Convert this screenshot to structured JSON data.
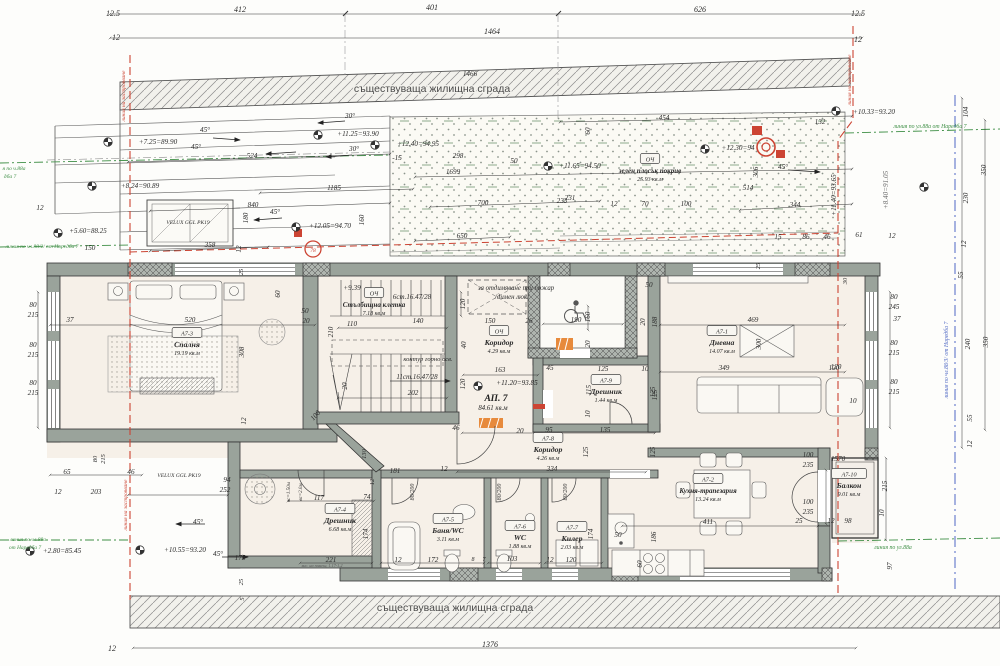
{
  "colors": {
    "wall": "#9aa39b",
    "hatch": "#8c8c8c",
    "red": "#cc4433",
    "green": "#3f8f46",
    "blue": "#4f68c4",
    "paper": "#f6f0e8"
  },
  "bands": {
    "top": "съществуваща жилищна сграда",
    "bottom": "съществуваща жилищна сграда"
  },
  "apartment": {
    "label": "АП. 7",
    "area": "84.61 кв.м",
    "level": "+11.20=93.85"
  },
  "rooms": [
    {
      "tag": "А7-3",
      "name": "Спалня",
      "area": "19.19 кв.м",
      "x": 187,
      "y": 338
    },
    {
      "tag": "ОЧ",
      "name": "Стълбищна клетка",
      "area": "7.18 кв.м",
      "x": 374,
      "y": 298
    },
    {
      "tag": "ОЧ",
      "name": "Коридор",
      "area": "4.29 кв.м",
      "x": 499,
      "y": 336
    },
    {
      "tag": "А7-9",
      "name": "Дрешник",
      "area": "1.44 кв.м",
      "x": 606,
      "y": 385
    },
    {
      "tag": "А7-1",
      "name": "Дневна",
      "area": "14.07 кв.м",
      "x": 722,
      "y": 336
    },
    {
      "tag": "А7-8",
      "name": "Коридор",
      "area": "4.26 кв.м",
      "x": 548,
      "y": 443
    },
    {
      "tag": "А7-2",
      "name": "Кухня-трапезария",
      "area": "13.24 кв.м",
      "x": 708,
      "y": 484
    },
    {
      "tag": "А7-10",
      "name": "Балкон",
      "area": "9.01 кв.м",
      "x": 849,
      "y": 479
    },
    {
      "tag": "А7-4",
      "name": "Дрешник",
      "area": "6.68 кв.м",
      "x": 340,
      "y": 514
    },
    {
      "tag": "А7-5",
      "name": "Баня/WC",
      "area": "3.11 кв.м",
      "x": 448,
      "y": 524
    },
    {
      "tag": "А7-6",
      "name": "WC",
      "area": "1.88 кв.м",
      "x": 520,
      "y": 531
    },
    {
      "tag": "А7-7",
      "name": "Килер",
      "area": "2.03 кв.м",
      "x": 572,
      "y": 532
    },
    {
      "tag": "ОЧ",
      "name": "зелен плосък покрив",
      "area": "25.93 кв.м",
      "x": 650,
      "y": 164
    }
  ],
  "level_markers": [
    {
      "x": 108,
      "y": 142
    },
    {
      "x": 92,
      "y": 186
    },
    {
      "x": 58,
      "y": 233
    },
    {
      "x": 318,
      "y": 135
    },
    {
      "x": 375,
      "y": 145
    },
    {
      "x": 296,
      "y": 227
    },
    {
      "x": 548,
      "y": 166
    },
    {
      "x": 836,
      "y": 111
    },
    {
      "x": 478,
      "y": 386
    },
    {
      "x": 140,
      "y": 550
    },
    {
      "x": 30,
      "y": 551
    },
    {
      "x": 705,
      "y": 149
    },
    {
      "x": 924,
      "y": 187
    }
  ],
  "labels": [
    {
      "t": "12.5",
      "x": 113,
      "y": 16,
      "s": 8
    },
    {
      "t": "412",
      "x": 240,
      "y": 12,
      "s": 8
    },
    {
      "t": "401",
      "x": 432,
      "y": 10,
      "s": 8
    },
    {
      "t": "626",
      "x": 700,
      "y": 12,
      "s": 8
    },
    {
      "t": "12.5",
      "x": 858,
      "y": 16,
      "s": 8
    },
    {
      "t": "12",
      "x": 116,
      "y": 40,
      "s": 8
    },
    {
      "t": "1464",
      "x": 492,
      "y": 34,
      "s": 8
    },
    {
      "t": "12",
      "x": 858,
      "y": 42,
      "s": 8
    },
    {
      "t": "1466",
      "x": 470,
      "y": 76
    },
    {
      "t": "+7.25=89.90",
      "x": 158,
      "y": 144
    },
    {
      "t": "45°",
      "x": 205,
      "y": 132
    },
    {
      "t": "45°",
      "x": 196,
      "y": 149
    },
    {
      "t": "30°",
      "x": 350,
      "y": 118
    },
    {
      "t": "+11.25=93.90",
      "x": 358,
      "y": 136
    },
    {
      "t": "30°",
      "x": 354,
      "y": 151
    },
    {
      "t": "524",
      "x": 252,
      "y": 158
    },
    {
      "t": "+12.40=94.95",
      "x": 418,
      "y": 146
    },
    {
      "t": "-15",
      "x": 397,
      "y": 160
    },
    {
      "t": "298",
      "x": 458,
      "y": 158
    },
    {
      "t": "50",
      "x": 514,
      "y": 163
    },
    {
      "t": "1699",
      "x": 453,
      "y": 174
    },
    {
      "t": "+8.24=90.89",
      "x": 140,
      "y": 188
    },
    {
      "t": "1185",
      "x": 334,
      "y": 190
    },
    {
      "t": "840",
      "x": 253,
      "y": 207
    },
    {
      "t": "180",
      "x": 248,
      "y": 218,
      "r": -90
    },
    {
      "t": "45°",
      "x": 275,
      "y": 214
    },
    {
      "t": "700",
      "x": 483,
      "y": 205
    },
    {
      "t": "233",
      "x": 562,
      "y": 203
    },
    {
      "t": "+12.05=94.70",
      "x": 330,
      "y": 228
    },
    {
      "t": "650",
      "x": 462,
      "y": 238
    },
    {
      "t": "358",
      "x": 210,
      "y": 247
    },
    {
      "t": "12",
      "x": 241,
      "y": 249,
      "r": -90
    },
    {
      "t": "160",
      "x": 364,
      "y": 220,
      "r": -90
    },
    {
      "t": "+5.60=88.25",
      "x": 88,
      "y": 233,
      "s": 7
    },
    {
      "t": "150",
      "x": 90,
      "y": 250
    },
    {
      "t": "12",
      "x": 40,
      "y": 210
    },
    {
      "t": "VELUX GGL PK19",
      "x": 188,
      "y": 224,
      "s": 5.5,
      "n": "skylight-label"
    },
    {
      "t": "454",
      "x": 664,
      "y": 120
    },
    {
      "t": "132",
      "x": 820,
      "y": 124
    },
    {
      "t": "+10.33=93.20",
      "x": 874,
      "y": 114
    },
    {
      "t": "линия по ул.88а от Наредба 7",
      "x": 930,
      "y": 128,
      "s": 5.8,
      "c": "#3f8f46",
      "n": "regulation-line-label"
    },
    {
      "t": "+11.65=94.50",
      "x": 580,
      "y": 168
    },
    {
      "t": "+12.30=94",
      "x": 738,
      "y": 150
    },
    {
      "t": "45°",
      "x": 783,
      "y": 169
    },
    {
      "t": "+8.40=91.05",
      "x": 888,
      "y": 190,
      "r": -90,
      "c": "#6a6a6a"
    },
    {
      "t": "+11.40=93.65",
      "x": 836,
      "y": 195,
      "r": -90
    },
    {
      "t": "514",
      "x": 748,
      "y": 190
    },
    {
      "t": "306",
      "x": 758,
      "y": 172,
      "r": -90
    },
    {
      "t": "231",
      "x": 570,
      "y": 200
    },
    {
      "t": "12",
      "x": 614,
      "y": 206
    },
    {
      "t": "70",
      "x": 645,
      "y": 206
    },
    {
      "t": "100",
      "x": 686,
      "y": 206
    },
    {
      "t": "344",
      "x": 795,
      "y": 207
    },
    {
      "t": "15",
      "x": 778,
      "y": 239
    },
    {
      "t": "86",
      "x": 806,
      "y": 239
    },
    {
      "t": "46",
      "x": 827,
      "y": 239
    },
    {
      "t": "61",
      "x": 859,
      "y": 237
    },
    {
      "t": "12",
      "x": 892,
      "y": 238
    },
    {
      "t": "60",
      "x": 590,
      "y": 131,
      "r": -90
    },
    {
      "t": "104",
      "x": 968,
      "y": 112,
      "r": -90
    },
    {
      "t": "350",
      "x": 986,
      "y": 170,
      "r": -90
    },
    {
      "t": "230",
      "x": 968,
      "y": 198,
      "r": -90
    },
    {
      "t": "12",
      "x": 966,
      "y": 244,
      "r": -90
    },
    {
      "t": "55",
      "x": 963,
      "y": 275,
      "r": -90
    },
    {
      "t": "240",
      "x": 970,
      "y": 344,
      "r": -90
    },
    {
      "t": "350",
      "x": 988,
      "y": 342,
      "r": -90
    },
    {
      "t": "55",
      "x": 972,
      "y": 418,
      "r": -90
    },
    {
      "t": "12",
      "x": 972,
      "y": 444,
      "r": -90
    },
    {
      "t": "линия по чл.88/3/ от Наредба 7",
      "x": 948,
      "y": 360,
      "r": -90,
      "s": 5.8,
      "c": "#4f68c4",
      "n": "regulation-line-label"
    },
    {
      "t": "80",
      "x": 894,
      "y": 299
    },
    {
      "t": "245",
      "x": 894,
      "y": 309
    },
    {
      "t": "37",
      "x": 897,
      "y": 321
    },
    {
      "t": "80",
      "x": 894,
      "y": 345
    },
    {
      "t": "215",
      "x": 894,
      "y": 355
    },
    {
      "t": "80",
      "x": 894,
      "y": 384
    },
    {
      "t": "215",
      "x": 894,
      "y": 394
    },
    {
      "t": "120",
      "x": 836,
      "y": 369
    },
    {
      "t": "10",
      "x": 853,
      "y": 403
    },
    {
      "t": "100",
      "x": 808,
      "y": 457
    },
    {
      "t": "235",
      "x": 808,
      "y": 467
    },
    {
      "t": "1570",
      "x": 838,
      "y": 461
    },
    {
      "t": "100",
      "x": 808,
      "y": 504
    },
    {
      "t": "235",
      "x": 808,
      "y": 514
    },
    {
      "t": "25",
      "x": 799,
      "y": 523
    },
    {
      "t": "12",
      "x": 831,
      "y": 523
    },
    {
      "t": "98",
      "x": 848,
      "y": 523
    },
    {
      "t": "215",
      "x": 887,
      "y": 486,
      "r": -90
    },
    {
      "t": "10",
      "x": 884,
      "y": 513,
      "r": -90
    },
    {
      "t": "97",
      "x": 892,
      "y": 566,
      "r": -90
    },
    {
      "t": "линия по ул.88а",
      "x": 893,
      "y": 549,
      "s": 5.8,
      "c": "#3f8f46",
      "n": "regulation-line-label"
    },
    {
      "t": "80",
      "x": 33,
      "y": 307
    },
    {
      "t": "215",
      "x": 33,
      "y": 317
    },
    {
      "t": "80",
      "x": 33,
      "y": 347
    },
    {
      "t": "215",
      "x": 33,
      "y": 357
    },
    {
      "t": "80",
      "x": 33,
      "y": 385
    },
    {
      "t": "215",
      "x": 33,
      "y": 395
    },
    {
      "t": "37",
      "x": 70,
      "y": 322
    },
    {
      "t": "520",
      "x": 190,
      "y": 322
    },
    {
      "t": "308",
      "x": 244,
      "y": 352,
      "r": -90
    },
    {
      "t": "60",
      "x": 280,
      "y": 294,
      "r": -90
    },
    {
      "t": "50",
      "x": 305,
      "y": 313
    },
    {
      "t": "20",
      "x": 306,
      "y": 323
    },
    {
      "t": "25",
      "x": 243,
      "y": 272,
      "r": -90,
      "s": 6.5
    },
    {
      "t": "12",
      "x": 246,
      "y": 421,
      "r": -90
    },
    {
      "t": "100",
      "x": 317,
      "y": 417,
      "r": -48
    },
    {
      "t": "65",
      "x": 67,
      "y": 474
    },
    {
      "t": "80",
      "x": 97,
      "y": 459,
      "r": -90,
      "s": 6.5
    },
    {
      "t": "215",
      "x": 105,
      "y": 459,
      "r": -90,
      "s": 6.5
    },
    {
      "t": "46",
      "x": 131,
      "y": 474
    },
    {
      "t": "12",
      "x": 58,
      "y": 494
    },
    {
      "t": "203",
      "x": 96,
      "y": 494
    },
    {
      "t": "VELUX GGL PK19",
      "x": 179,
      "y": 477,
      "s": 5.5,
      "n": "skylight-label"
    },
    {
      "t": "94",
      "x": 227,
      "y": 482
    },
    {
      "t": "252",
      "x": 225,
      "y": 492
    },
    {
      "t": "45°",
      "x": 198,
      "y": 524
    },
    {
      "t": "+10.55=93.20",
      "x": 185,
      "y": 552
    },
    {
      "t": "45°",
      "x": 218,
      "y": 556
    },
    {
      "t": "175",
      "x": 240,
      "y": 560
    },
    {
      "t": "+2.80=85.45",
      "x": 62,
      "y": 553
    },
    {
      "t": "линия по чл.88а",
      "x": 28,
      "y": 541,
      "s": 5.5,
      "c": "#3f8f46",
      "n": "regulation-line-label"
    },
    {
      "t": "от Наредба 7",
      "x": 25,
      "y": 549,
      "s": 5.5,
      "c": "#3f8f46",
      "n": "regulation-line-label"
    },
    {
      "t": "линия по чл.88/2/ от Наредба 7",
      "x": 42,
      "y": 248,
      "s": 5.5,
      "c": "#3f8f46",
      "n": "regulation-line-label"
    },
    {
      "t": "я по ч.88а",
      "x": 14,
      "y": 170,
      "s": 5.5,
      "c": "#3f8f46",
      "n": "regulation-line-label"
    },
    {
      "t": "дба 7",
      "x": 10,
      "y": 178,
      "s": 5.5,
      "c": "#3f8f46",
      "n": "regulation-line-label"
    },
    {
      "t": "линия на застрояване",
      "x": 125,
      "y": 96,
      "r": -90,
      "s": 5.5,
      "c": "#cc4433",
      "n": "building-line-label"
    },
    {
      "t": "линия на застрояване",
      "x": 127,
      "y": 505,
      "r": -90,
      "s": 5.5,
      "c": "#cc4433",
      "n": "building-line-label"
    },
    {
      "t": "линия на застрояване",
      "x": 851,
      "y": 80,
      "r": -90,
      "s": 5.5,
      "c": "#cc4433",
      "n": "building-line-label"
    },
    {
      "t": "+9.39",
      "x": 352,
      "y": 290
    },
    {
      "t": "6ст.16.47/28",
      "x": 412,
      "y": 299,
      "s": 7
    },
    {
      "t": "110",
      "x": 352,
      "y": 326
    },
    {
      "t": "140",
      "x": 418,
      "y": 323
    },
    {
      "t": "210",
      "x": 333,
      "y": 332,
      "r": -90
    },
    {
      "t": "контур горно осв.",
      "x": 428,
      "y": 361,
      "s": 6.5
    },
    {
      "t": "11ст.16.47/28",
      "x": 417,
      "y": 379,
      "s": 7
    },
    {
      "t": "202",
      "x": 413,
      "y": 395
    },
    {
      "t": "20",
      "x": 347,
      "y": 386,
      "r": -90
    },
    {
      "t": "за отдимяване при пожар",
      "x": 516,
      "y": 290,
      "s": 6.8
    },
    {
      "t": "/димен люк/",
      "x": 512,
      "y": 299,
      "s": 6.8
    },
    {
      "t": "120",
      "x": 465,
      "y": 304,
      "r": -90
    },
    {
      "t": "150",
      "x": 490,
      "y": 323
    },
    {
      "t": "26",
      "x": 529,
      "y": 323
    },
    {
      "t": "40",
      "x": 466,
      "y": 345,
      "r": -90
    },
    {
      "t": "163",
      "x": 500,
      "y": 372
    },
    {
      "t": "120",
      "x": 465,
      "y": 384,
      "r": -90
    },
    {
      "t": "190",
      "x": 576,
      "y": 322
    },
    {
      "t": "160",
      "x": 590,
      "y": 317,
      "r": -90
    },
    {
      "t": "20",
      "x": 590,
      "y": 344,
      "r": -90
    },
    {
      "t": "50",
      "x": 649,
      "y": 287
    },
    {
      "t": "188",
      "x": 657,
      "y": 322,
      "r": -90
    },
    {
      "t": "20",
      "x": 645,
      "y": 322,
      "r": -90
    },
    {
      "t": "125",
      "x": 603,
      "y": 371
    },
    {
      "t": "10",
      "x": 645,
      "y": 371
    },
    {
      "t": "115",
      "x": 591,
      "y": 390,
      "r": -90
    },
    {
      "t": "10",
      "x": 590,
      "y": 414,
      "r": -90
    },
    {
      "t": "135",
      "x": 605,
      "y": 432
    },
    {
      "t": "125",
      "x": 657,
      "y": 395,
      "r": -90
    },
    {
      "t": "45",
      "x": 550,
      "y": 370
    },
    {
      "t": "469",
      "x": 753,
      "y": 322
    },
    {
      "t": "349",
      "x": 724,
      "y": 370
    },
    {
      "t": "120",
      "x": 834,
      "y": 370
    },
    {
      "t": "125",
      "x": 655,
      "y": 392,
      "r": -90
    },
    {
      "t": "300",
      "x": 761,
      "y": 344,
      "r": -90
    },
    {
      "t": "25",
      "x": 760,
      "y": 266,
      "r": -90,
      "s": 6.5
    },
    {
      "t": "30",
      "x": 847,
      "y": 281,
      "r": -90,
      "s": 6.5
    },
    {
      "t": "411",
      "x": 708,
      "y": 524
    },
    {
      "t": "186",
      "x": 656,
      "y": 537,
      "r": -90
    },
    {
      "t": "60",
      "x": 642,
      "y": 564,
      "r": -90
    },
    {
      "t": "50",
      "x": 618,
      "y": 537
    },
    {
      "t": "125",
      "x": 588,
      "y": 452,
      "r": -90
    },
    {
      "t": "125",
      "x": 655,
      "y": 452,
      "r": -90
    },
    {
      "t": "95",
      "x": 549,
      "y": 432
    },
    {
      "t": "20",
      "x": 520,
      "y": 433
    },
    {
      "t": "334",
      "x": 552,
      "y": 471
    },
    {
      "t": "12",
      "x": 444,
      "y": 471
    },
    {
      "t": "46",
      "x": 456,
      "y": 430
    },
    {
      "t": "117",
      "x": 319,
      "y": 500
    },
    {
      "t": "74",
      "x": 367,
      "y": 499
    },
    {
      "t": "181",
      "x": 395,
      "y": 473
    },
    {
      "t": "12",
      "x": 374,
      "y": 482,
      "r": -90,
      "s": 6.5
    },
    {
      "t": "130",
      "x": 366,
      "y": 454,
      "r": -90,
      "s": 6.5
    },
    {
      "t": "221",
      "x": 331,
      "y": 562
    },
    {
      "t": "вис. на помещ. 1.17-1.2",
      "x": 322,
      "y": 567,
      "s": 4.2,
      "c": "#555"
    },
    {
      "t": "174",
      "x": 368,
      "y": 534,
      "r": -90
    },
    {
      "t": "12",
      "x": 398,
      "y": 562
    },
    {
      "t": "172",
      "x": 433,
      "y": 562
    },
    {
      "t": "вс=1.50м",
      "x": 290,
      "y": 492,
      "r": -90,
      "s": 5
    },
    {
      "t": "вс=2.0м",
      "x": 302,
      "y": 492,
      "r": -90,
      "s": 5
    },
    {
      "t": "80/200",
      "x": 414,
      "y": 492,
      "r": -90,
      "s": 6
    },
    {
      "t": "80/200",
      "x": 501,
      "y": 492,
      "r": -90,
      "s": 6
    },
    {
      "t": "80/200",
      "x": 567,
      "y": 492,
      "r": -90,
      "s": 6
    },
    {
      "t": "8",
      "x": 473,
      "y": 561,
      "s": 6
    },
    {
      "t": "7",
      "x": 484,
      "y": 561,
      "s": 6
    },
    {
      "t": "103",
      "x": 512,
      "y": 561
    },
    {
      "t": "12",
      "x": 550,
      "y": 562
    },
    {
      "t": "120",
      "x": 571,
      "y": 562
    },
    {
      "t": "174",
      "x": 593,
      "y": 534,
      "r": -90
    },
    {
      "t": "25",
      "x": 243,
      "y": 582,
      "r": -90,
      "s": 6.5
    },
    {
      "t": "5",
      "x": 244,
      "y": 599,
      "r": -90,
      "s": 6.5
    },
    {
      "t": "12",
      "x": 112,
      "y": 651,
      "s": 8
    },
    {
      "t": "1376",
      "x": 490,
      "y": 647,
      "s": 8
    },
    {
      "t": "78",
      "x": 313,
      "y": 252,
      "s": 5.5,
      "c": "#cc4433",
      "n": "roof-marker-label"
    }
  ]
}
